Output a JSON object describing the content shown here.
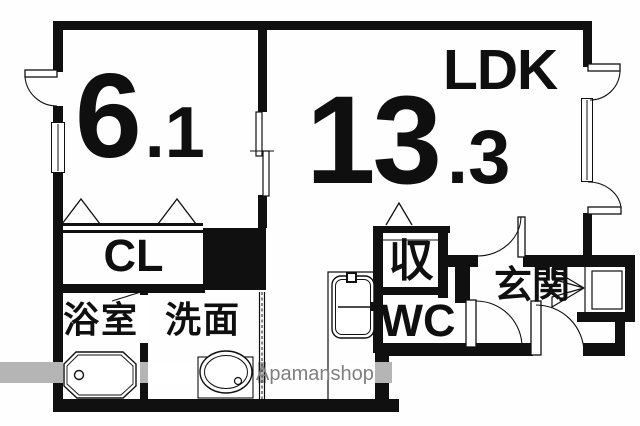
{
  "plan": {
    "type": "apartment-floorplan",
    "rooms": {
      "western": {
        "area_main": "6",
        "area_decimal": ".1"
      },
      "ldk": {
        "name": "LDK",
        "area_main": "13",
        "area_decimal": ".3"
      },
      "closet": {
        "label": "CL"
      },
      "bathroom": {
        "label": "浴室"
      },
      "washroom": {
        "label": "洗面"
      },
      "storage": {
        "label": "収"
      },
      "toilet": {
        "label": "WC"
      },
      "entrance": {
        "label": "玄関"
      }
    },
    "watermark": {
      "text": "Apamanshop"
    },
    "colors": {
      "wall": "#101010",
      "background": "#ffffff",
      "watermark_band": "#b5b5b5",
      "watermark_text": "#7f7f7f"
    },
    "fixtures": [
      "bathtub",
      "washbasin",
      "kitchen-sink",
      "swing-doors",
      "folding-closet-doors",
      "sliding-door",
      "accordion-door",
      "windows",
      "shoe-storage"
    ]
  }
}
